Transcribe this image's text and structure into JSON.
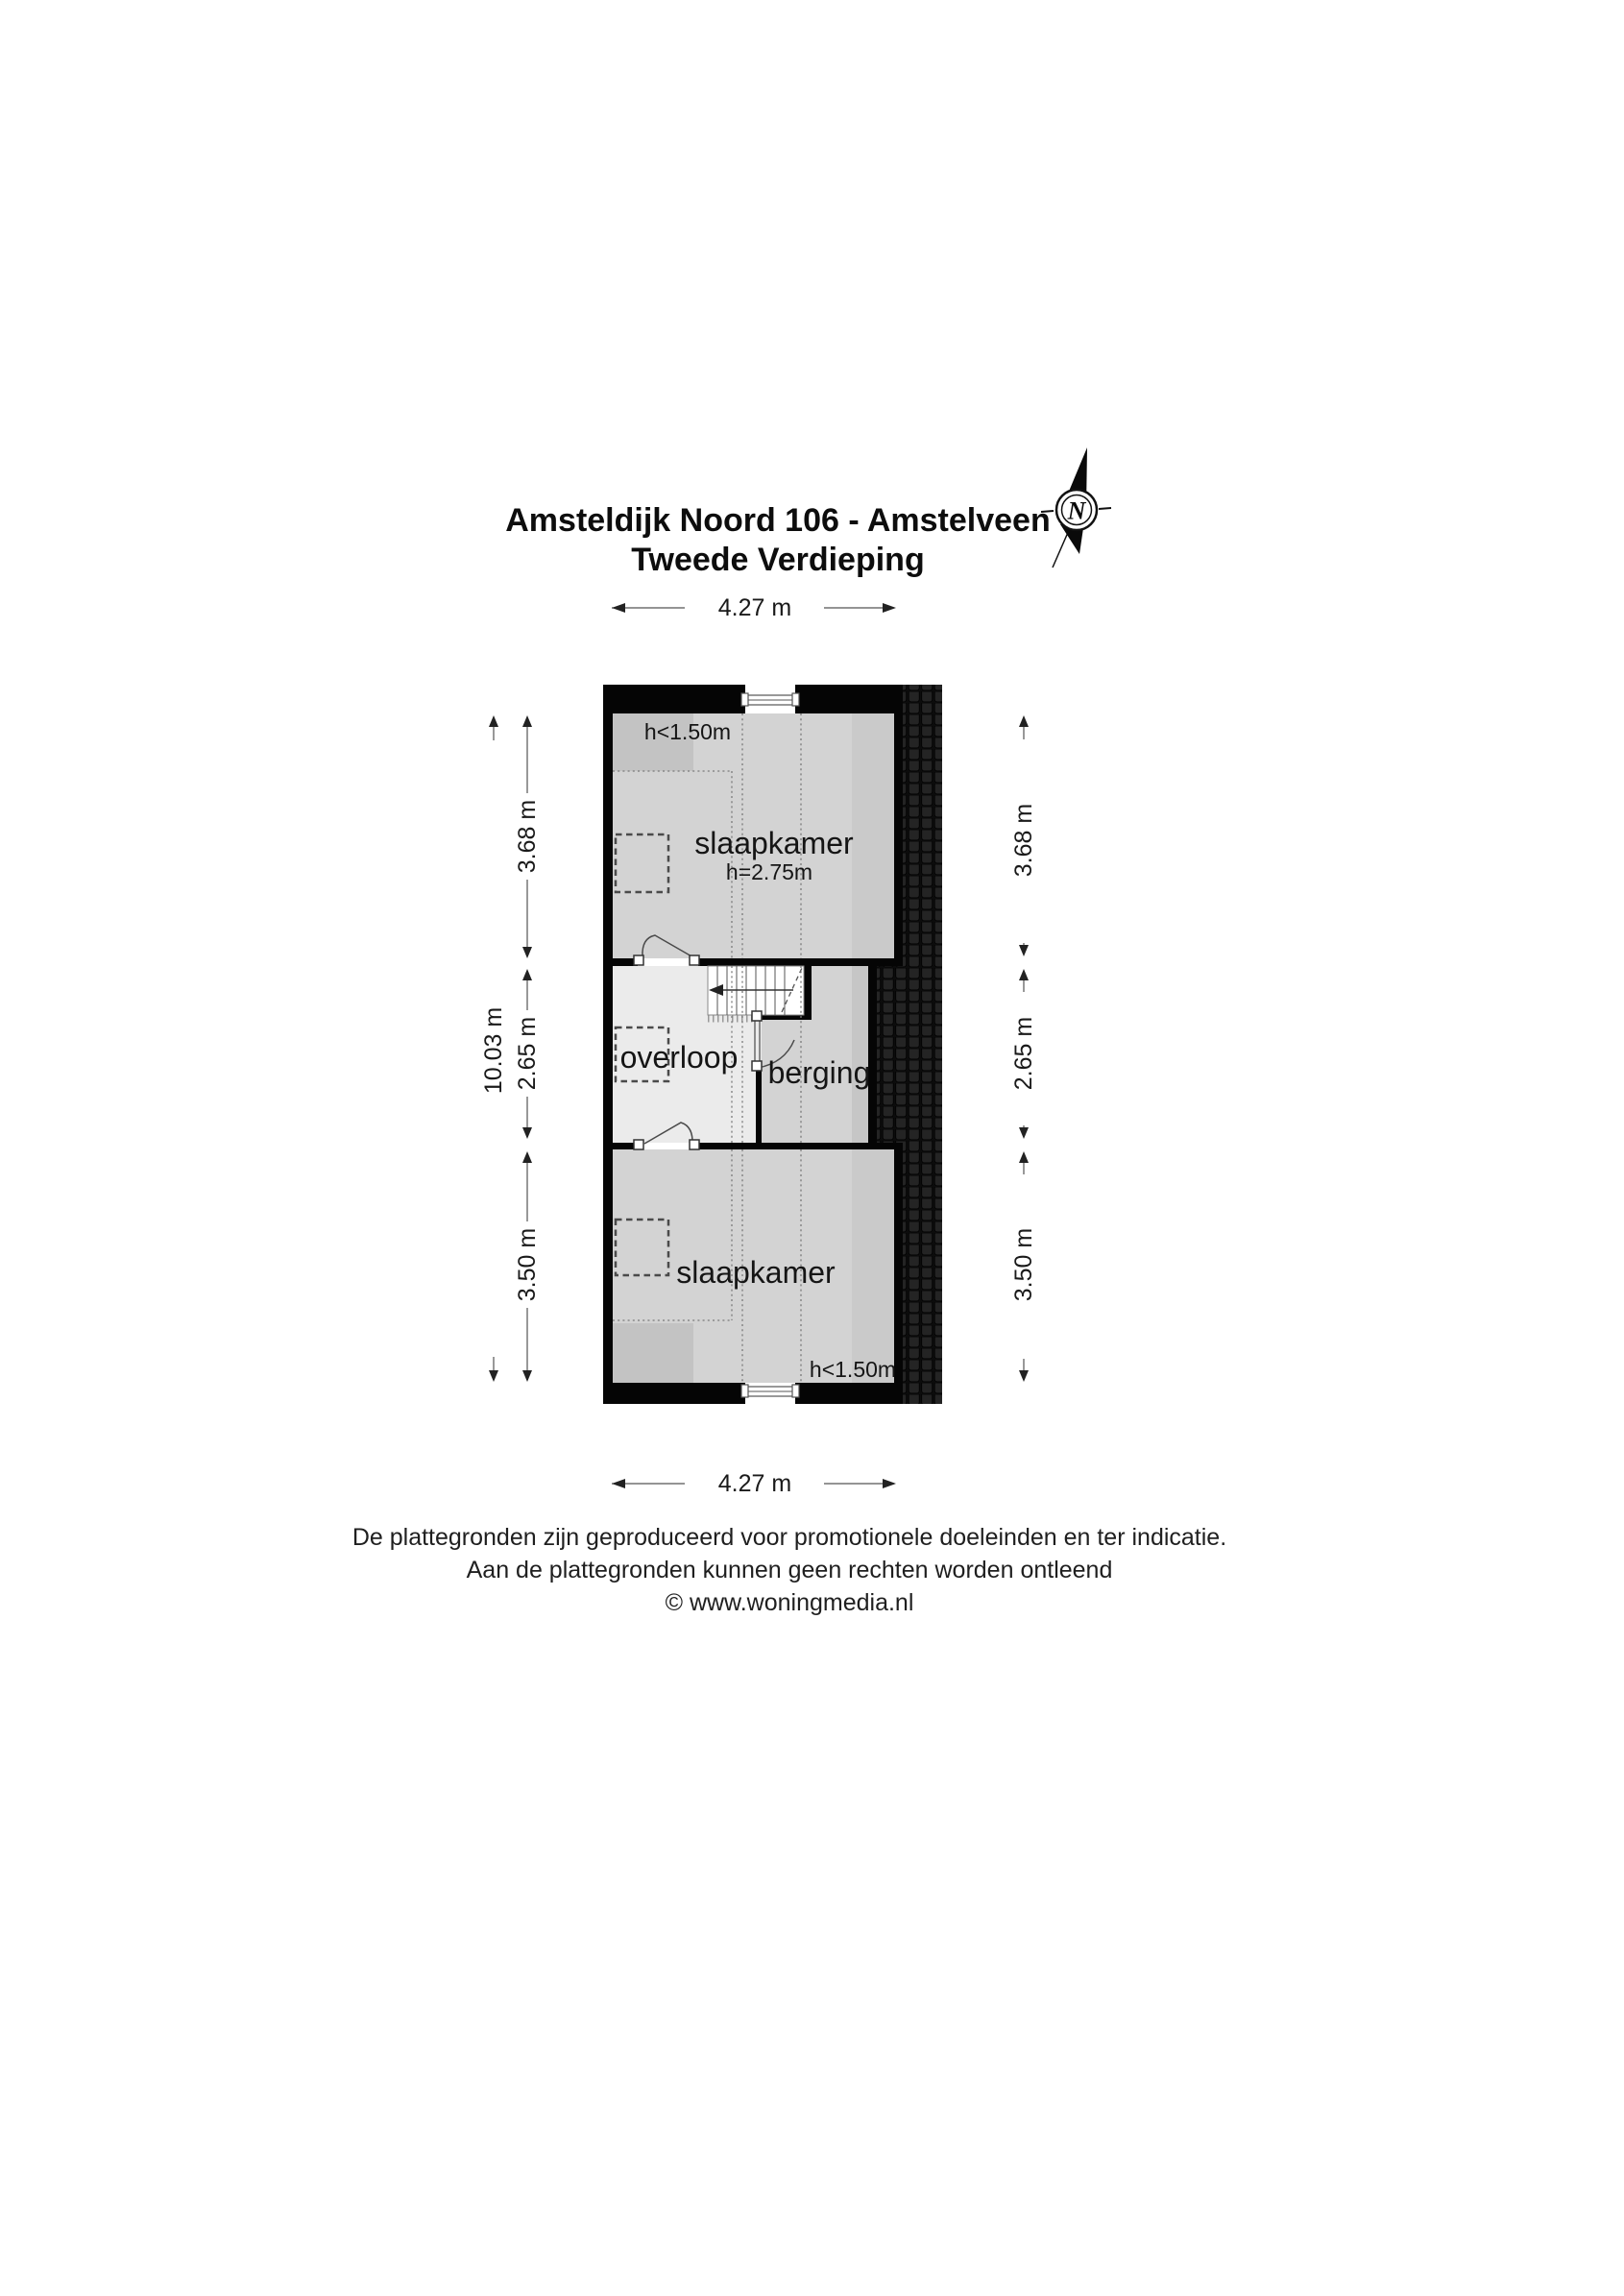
{
  "title": {
    "line1": "Amsteldijk Noord 106 - Amstelveen",
    "line2": "Tweede Verdieping"
  },
  "compass": {
    "north": "N"
  },
  "rooms": {
    "top_bedroom": {
      "name": "slaapkamer",
      "ceiling_height": "h=2.75m",
      "low_ceiling_note": "h<1.50m"
    },
    "landing": {
      "name": "overloop"
    },
    "storage": {
      "name": "berging"
    },
    "bottom_bedroom": {
      "name": "slaapkamer",
      "low_ceiling_note": "h<1.50m"
    }
  },
  "dimensions": {
    "top_width": "4.27 m",
    "bottom_width": "4.27 m",
    "total_height_left": "10.03 m",
    "left": [
      "3.68 m",
      "2.65 m",
      "3.50 m"
    ],
    "right": [
      "3.68 m",
      "2.65 m",
      "3.50 m"
    ]
  },
  "footer": {
    "line1": "De plattegronden zijn geproduceerd voor promotionele doeleinden en ter indicatie.",
    "line2": "Aan de plattegronden kunnen geen rechten worden ontleend",
    "line3": "© www.woningmedia.nl"
  },
  "colors": {
    "wall": "#050505",
    "room_fill": "#d3d3d3",
    "room_fill_dark": "#c3c3c3",
    "room_band": "#cacaca",
    "storage_band": "#c6c6c6",
    "landing_fill": "#ebebeb",
    "stair_fill": "#ffffff",
    "roof_tile": "#0c0c0c"
  }
}
